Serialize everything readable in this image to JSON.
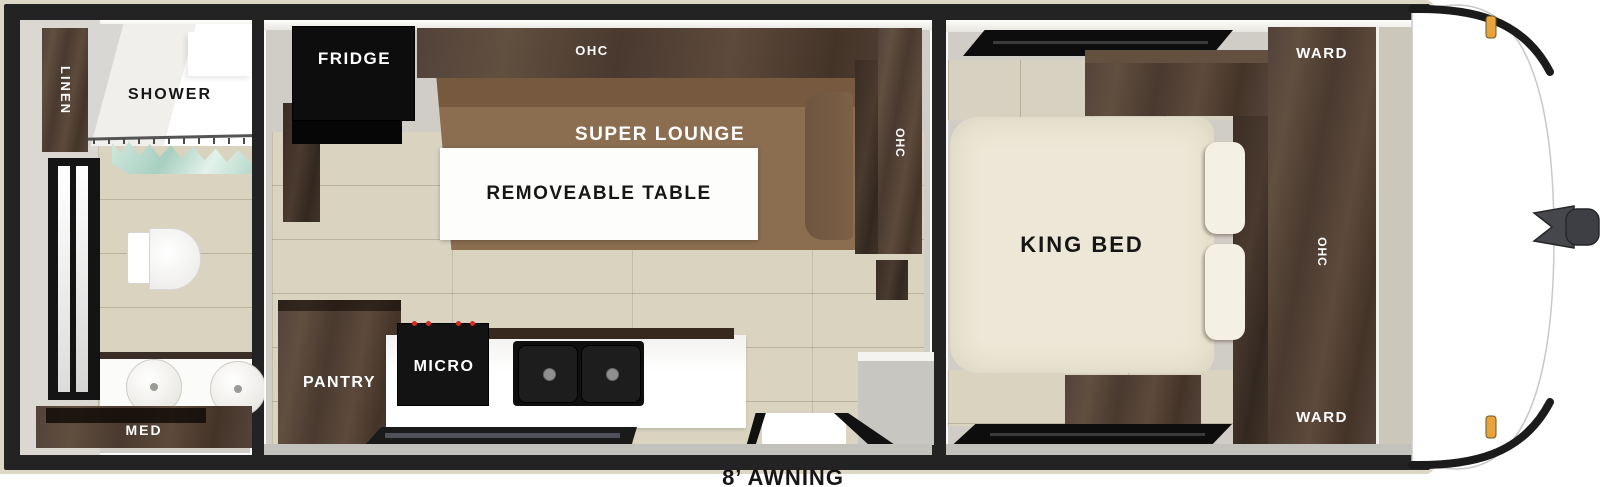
{
  "labels": {
    "awning": "8’ AWNING",
    "bathroom": {
      "linen": "LINEN",
      "shower": "SHOWER",
      "med": "MED"
    },
    "kitchen_living": {
      "fridge": "FRIDGE",
      "ohc_top": "OHC",
      "super_lounge": "SUPER LOUNGE",
      "removeable_table": "REMOVEABLE TABLE",
      "ohc_side": "OHC",
      "pantry": "PANTRY",
      "micro": "MICRO"
    },
    "bedroom": {
      "king_bed": "KING BED",
      "ward_front": "WARD",
      "ohc_side": "OHC",
      "ward_rear": "WARD"
    }
  },
  "colors": {
    "dark_wood": "#4e3d33",
    "lounge_brown": "#8a6c4e",
    "bed_cream": "#ece7d6",
    "appliance_black": "#131313",
    "floor_beige": "#d9d3c0",
    "wall_gray": "#d0cdc6",
    "glass_teal": "#cfe8dc",
    "marker_amber": "#e7a33c",
    "burner_red": "#d22d20"
  }
}
